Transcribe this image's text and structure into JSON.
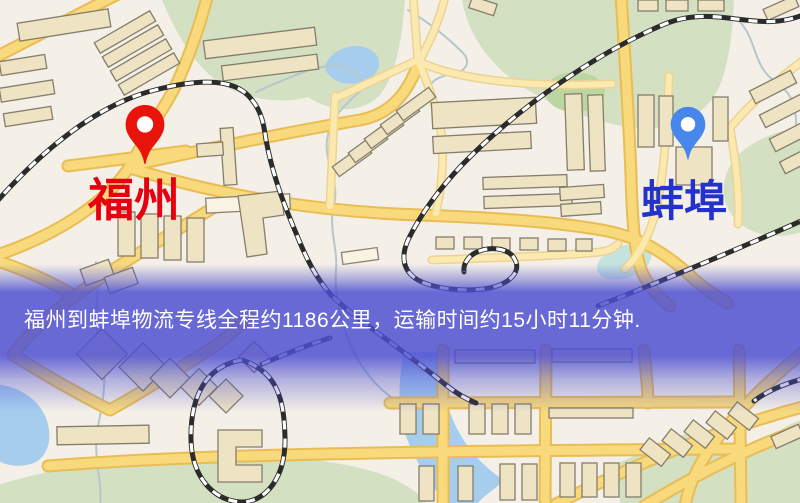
{
  "map": {
    "origin": {
      "label": "福州",
      "label_color": "#e60010",
      "pin_color": "#e8140c"
    },
    "destination": {
      "label": "蚌埠",
      "label_color": "#2332cd",
      "pin_color": "#4787ec"
    }
  },
  "banner": {
    "text": "福州到蚌埠物流专线全程约1186公里，运输时间约15小时11分钟.",
    "background_color": "#4d4fd1",
    "text_color": "#ffffff"
  },
  "palette": {
    "map_background": "#f4f0e7",
    "road_fill": "#f8d97c",
    "road_casing": "#e9bd55",
    "secondary_road_fill": "#fbe9af",
    "park_green": "#d3e0c2",
    "water_blue": "#a6cdee",
    "building_fill": "#eee4c4",
    "building_stroke": "#857d6c",
    "railway_dark": "#2b2b2b"
  }
}
